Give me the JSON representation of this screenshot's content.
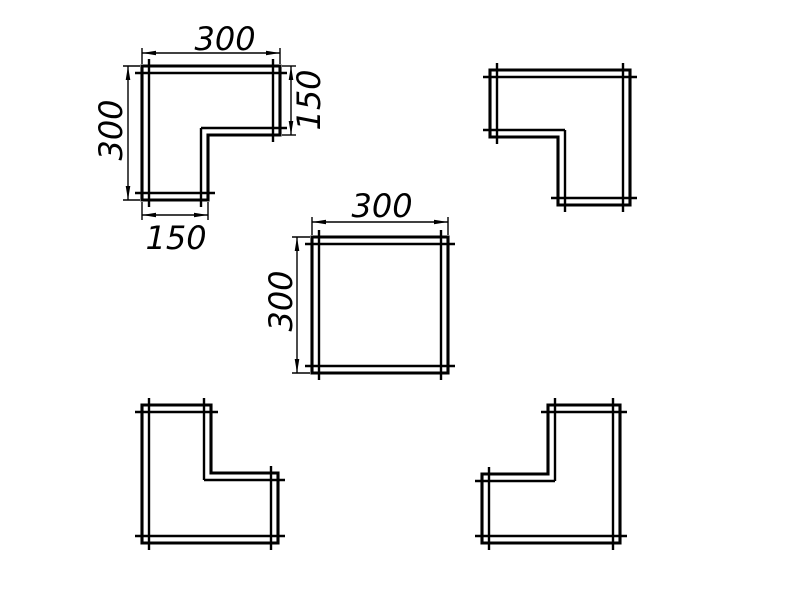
{
  "canvas": {
    "width": 800,
    "height": 600,
    "background": "#ffffff"
  },
  "drawing": {
    "stroke_color": "#000000",
    "shapes": [
      {
        "name": "l-profile-notch-bottom-right",
        "points": [
          [
            142,
            66
          ],
          [
            280,
            66
          ],
          [
            280,
            135
          ],
          [
            208,
            135
          ],
          [
            208,
            200
          ],
          [
            142,
            200
          ]
        ]
      },
      {
        "name": "l-profile-notch-bottom-left",
        "points": [
          [
            490,
            70
          ],
          [
            630,
            70
          ],
          [
            630,
            205
          ],
          [
            558,
            205
          ],
          [
            558,
            137
          ],
          [
            490,
            137
          ]
        ]
      },
      {
        "name": "square-profile",
        "points": [
          [
            312,
            237
          ],
          [
            448,
            237
          ],
          [
            448,
            373
          ],
          [
            312,
            373
          ]
        ]
      },
      {
        "name": "l-profile-notch-top-right",
        "points": [
          [
            142,
            405
          ],
          [
            211,
            405
          ],
          [
            211,
            473
          ],
          [
            278,
            473
          ],
          [
            278,
            543
          ],
          [
            142,
            543
          ]
        ]
      },
      {
        "name": "l-profile-notch-top-left",
        "points": [
          [
            548,
            405
          ],
          [
            620,
            405
          ],
          [
            620,
            543
          ],
          [
            482,
            543
          ],
          [
            482,
            474
          ],
          [
            548,
            474
          ]
        ]
      }
    ],
    "dimensions": [
      {
        "label": "300",
        "axis": "h",
        "p1": [
          142,
          66
        ],
        "p2": [
          280,
          66
        ],
        "line_pos": 53,
        "text": [
          225,
          39
        ]
      },
      {
        "label": "300",
        "axis": "v",
        "p1": [
          142,
          66
        ],
        "p2": [
          142,
          200
        ],
        "line_pos": 128,
        "text": [
          111,
          130
        ]
      },
      {
        "label": "150",
        "axis": "v",
        "p1": [
          280,
          66
        ],
        "p2": [
          280,
          135
        ],
        "line_pos": 291,
        "text": [
          309,
          100
        ]
      },
      {
        "label": "150",
        "axis": "h",
        "p1": [
          142,
          200
        ],
        "p2": [
          208,
          200
        ],
        "line_pos": 215,
        "text": [
          176,
          238
        ]
      },
      {
        "label": "300",
        "axis": "h",
        "p1": [
          312,
          237
        ],
        "p2": [
          448,
          237
        ],
        "line_pos": 222,
        "text": [
          382,
          206
        ]
      },
      {
        "label": "300",
        "axis": "v",
        "p1": [
          312,
          237
        ],
        "p2": [
          312,
          373
        ],
        "line_pos": 297,
        "text": [
          281,
          301
        ]
      }
    ]
  }
}
